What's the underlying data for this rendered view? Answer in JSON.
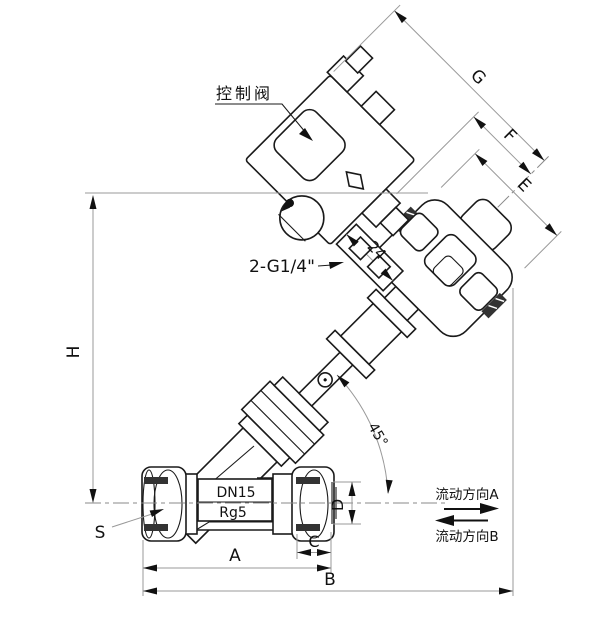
{
  "drawing": {
    "title": "angle-seat-valve-technical-drawing",
    "part_labels": {
      "control_valve": "控制阀",
      "air_ports": "2-G1/4\"",
      "body_size": "DN15",
      "body_material": "Rg5",
      "union_nut": "S"
    },
    "dimensions": {
      "g": "G",
      "f": "F",
      "e": "E",
      "h": "H",
      "a": "A",
      "b": "B",
      "c": "C",
      "d": "D",
      "angle": "45°",
      "port_spacing": "24"
    },
    "flow_legend": {
      "direction_a": "流动方向A",
      "direction_b": "流动方向B"
    },
    "colors": {
      "line": "#1a1a1a",
      "dimension_line": "#999999",
      "arrowhead": "#111111",
      "background": "#ffffff"
    }
  }
}
